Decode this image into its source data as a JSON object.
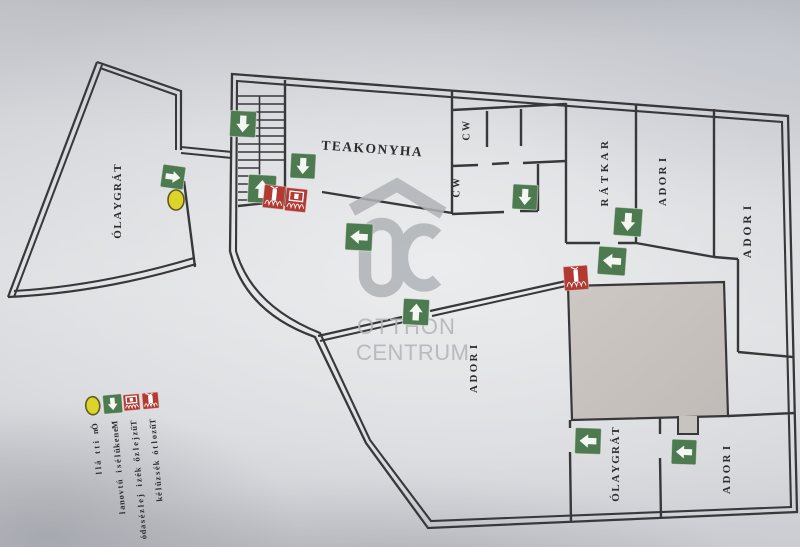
{
  "plan": {
    "colors": {
      "wall": "#38383b",
      "arrow_green": "#4d7a50",
      "fire_red": "#b23a33",
      "marker_yellow": "#ded32b",
      "room_fill": "#c8c3bf",
      "label_ink": "#2b2c2e",
      "watermark_gray": "#b0b3b7"
    },
    "watermark": {
      "word1": "OTTHON",
      "word2": "CENTRUM",
      "monogram": "OC"
    },
    "kitchen_label": "TEAKONYHA",
    "room_labels": [
      {
        "id": "targyalo-west",
        "label": "TÁRGYALÓ",
        "x": 118,
        "y": 168,
        "step": 9.5,
        "size": 11
      },
      {
        "id": "wc-upper",
        "label": "WC",
        "x": 467,
        "y": 126,
        "step": 11,
        "size": 10
      },
      {
        "id": "wc-lower",
        "label": "WC",
        "x": 457,
        "y": 183,
        "step": 11,
        "size": 10
      },
      {
        "id": "raktar",
        "label": "RAKTÁR",
        "x": 605,
        "y": 145,
        "step": 11.5,
        "size": 11
      },
      {
        "id": "iroda-top",
        "label": "IRODA",
        "x": 663,
        "y": 160,
        "step": 10.5,
        "size": 11
      },
      {
        "id": "iroda-east",
        "label": "IRODA",
        "x": 748,
        "y": 208,
        "step": 11.5,
        "size": 11.5
      },
      {
        "id": "iroda-center",
        "label": "IRODA",
        "x": 474,
        "y": 347,
        "step": 10.5,
        "size": 11
      },
      {
        "id": "targyalo-south",
        "label": "TÁRGYALÓ",
        "x": 616,
        "y": 431,
        "step": 9.5,
        "size": 11
      },
      {
        "id": "iroda-south",
        "label": "IRODA",
        "x": 727,
        "y": 448,
        "step": 10.5,
        "size": 11
      }
    ],
    "exit_arrows": [
      {
        "x": 243,
        "y": 124,
        "dir": "down",
        "size": 26,
        "rot": 3
      },
      {
        "x": 262,
        "y": 189,
        "dir": "up",
        "size": 28,
        "rot": 3
      },
      {
        "x": 303,
        "y": 166,
        "dir": "down",
        "size": 25,
        "rot": 3
      },
      {
        "x": 173,
        "y": 177,
        "dir": "right",
        "size": 23,
        "rot": 8
      },
      {
        "x": 525,
        "y": 197,
        "dir": "down",
        "size": 25,
        "rot": 3
      },
      {
        "x": 359,
        "y": 237,
        "dir": "left",
        "size": 27,
        "rot": 3
      },
      {
        "x": 416,
        "y": 312,
        "dir": "up",
        "size": 26,
        "rot": 3
      },
      {
        "x": 628,
        "y": 222,
        "dir": "down",
        "size": 28,
        "rot": 4
      },
      {
        "x": 612,
        "y": 261,
        "dir": "left",
        "size": 28,
        "rot": 4
      },
      {
        "x": 588,
        "y": 441,
        "dir": "left",
        "size": 26,
        "rot": 2
      },
      {
        "x": 684,
        "y": 452,
        "dir": "left",
        "size": 25,
        "rot": 2
      }
    ],
    "fire_icons": [
      {
        "x": 274,
        "y": 197,
        "w": 21,
        "h": 23,
        "type": "extinguisher",
        "rot": 6
      },
      {
        "x": 296,
        "y": 200,
        "w": 21,
        "h": 23,
        "type": "alarm",
        "rot": 6
      },
      {
        "x": 576,
        "y": 278,
        "w": 24,
        "h": 24,
        "type": "extinguisher",
        "rot": -4
      }
    ],
    "you_are_here": {
      "x": 176,
      "y": 200,
      "rx": 8,
      "ry": 10
    },
    "legend": {
      "tilt": -5,
      "icon_y": 403,
      "text_y": 424,
      "char_step": 5.2,
      "font_size": 8.5,
      "items": [
        {
          "icon": "you-are-here-marker",
          "label": "Ön itt áll",
          "x": 95
        },
        {
          "icon": "escape-route-arrow",
          "label": "Menekülési útvonal",
          "x": 115
        },
        {
          "icon": "fire-alarm-call-point",
          "label": "Tűzjelző kézi jelzésadó",
          "x": 134
        },
        {
          "icon": "fire-extinguisher",
          "label": "Tűzoltó készülék",
          "x": 153
        }
      ]
    }
  }
}
